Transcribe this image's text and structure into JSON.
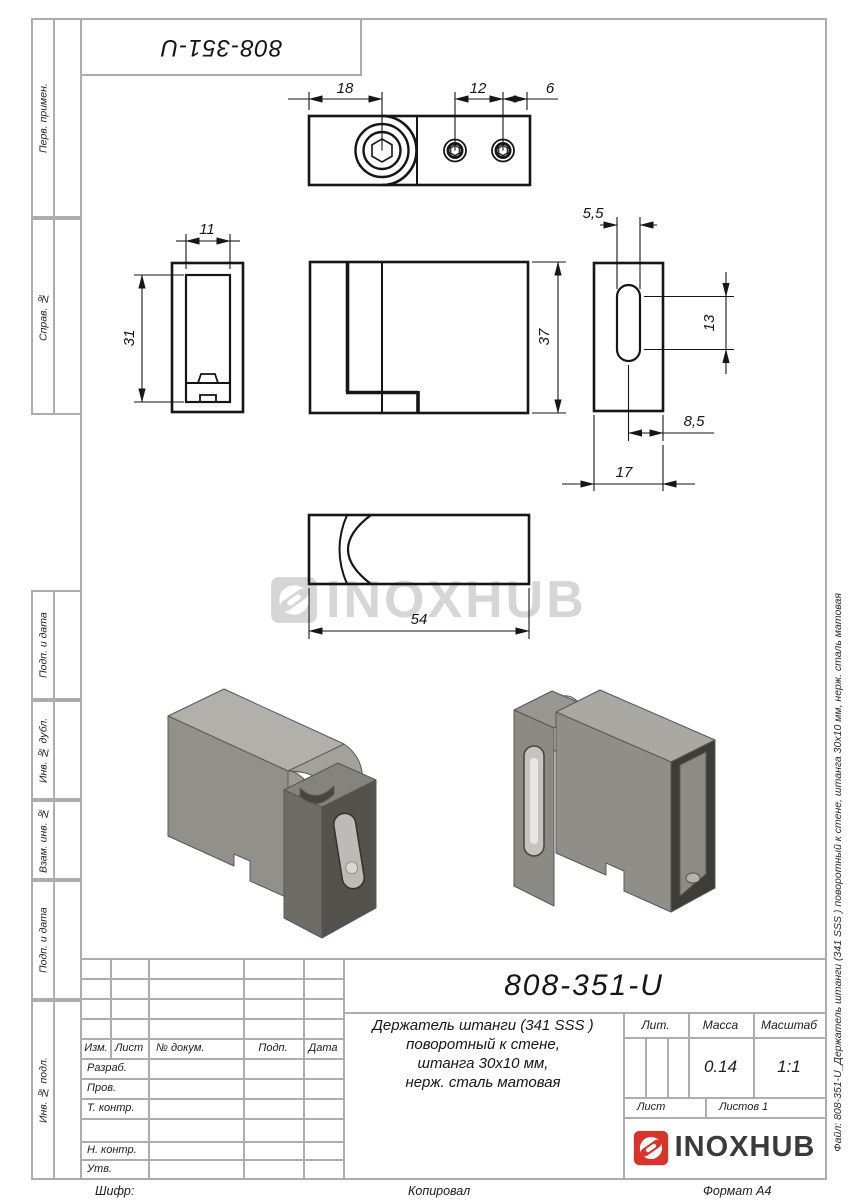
{
  "sheet": {
    "top_designation": "808-351-U",
    "watermark_text": "INOXHUB",
    "file_note": "Файл: 808-351-U_Держатель штанги (341 SSS ) поворотный к стене, штанга 30х10 мм, нерж. сталь матовая",
    "footer": {
      "cipher": "Шифр:",
      "copied": "Копировал",
      "format": "Формат А4"
    }
  },
  "left_margin": {
    "labels": [
      "Перв. примен.",
      "Справ. №",
      "Подп. и дата",
      "Инв. № дубл.",
      "Взам. инв. №",
      "Подп. и дата",
      "Инв. № подл."
    ]
  },
  "dimensions": {
    "top_width": "18",
    "screw_spacing": "12",
    "screw_edge": "6",
    "side_width": "11",
    "side_height": "31",
    "front_height": "37",
    "slot_width": "5,5",
    "slot_length": "13",
    "slot_offset": "8,5",
    "plate_width": "17",
    "body_length": "54"
  },
  "title_block": {
    "designation": "808-351-U",
    "description_lines": [
      "Держатель штанги (341 SSS )",
      "поворотный к стене,",
      "штанга 30х10 мм,",
      "нерж. сталь матовая"
    ],
    "header_row": [
      "Изм.",
      "Лист",
      "№ докум.",
      "Подп.",
      "Дата"
    ],
    "signature_rows": [
      "Разраб.",
      "Пров.",
      "Т. контр.",
      "Н. контр.",
      "Утв."
    ],
    "lit_label": "Лит.",
    "mass_label": "Масса",
    "scale_label": "Масштаб",
    "mass_value": "0.14",
    "scale_value": "1:1",
    "sheet_label": "Лист",
    "sheets_label": "Листов 1",
    "logo_text": "INOXHUB",
    "logo_color": "#d7352b"
  }
}
